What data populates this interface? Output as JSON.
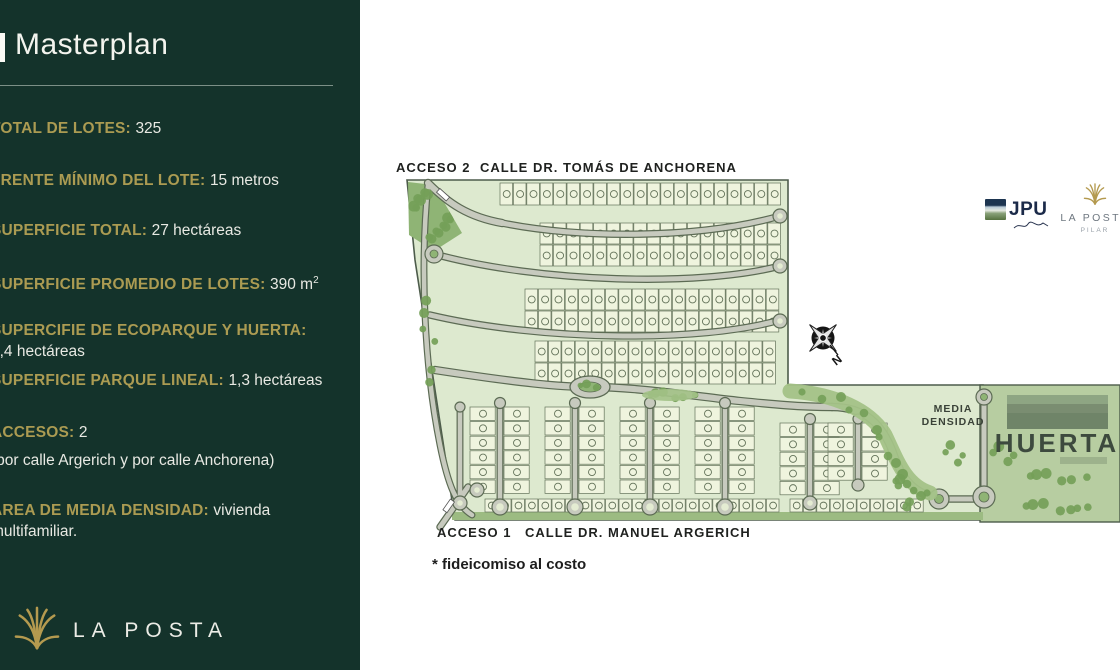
{
  "sidebar": {
    "title": "Masterplan",
    "items": [
      {
        "label": "TOTAL DE LOTES: ",
        "value": "325"
      },
      {
        "label": "FRENTE MÍNIMO DEL LOTE: ",
        "value": "15 metros"
      },
      {
        "label": "SUPERFICIE TOTAL: ",
        "value": "27 hectáreas"
      },
      {
        "label": "SUPERFICIE PROMEDIO DE LOTES: ",
        "value": "390 m",
        "superscript": "2"
      },
      {
        "label": "SUPERCIFIE DE ECOPARQUE Y HUERTA:",
        "value": "4,4 hectáreas"
      },
      {
        "label": "SUPERFICIE PARQUE LINEAL: ",
        "value": "1,3 hectáreas"
      },
      {
        "label": "ACCESOS: ",
        "value": "2",
        "note": "(por calle Argerich y por calle Anchorena)"
      },
      {
        "label": "ÁREA DE MEDIA DENSIDAD: ",
        "value": "vivienda multifamiliar."
      }
    ],
    "footer_logo_text": "LA POSTA"
  },
  "map": {
    "acceso2": "ACCESO 2",
    "calle_top": "CALLE DR. TOMÁS DE ANCHORENA",
    "acceso1": "ACCESO 1",
    "calle_bottom": "CALLE DR. MANUEL ARGERICH",
    "media_densidad_line1": "MEDIA",
    "media_densidad_line2": "DENSIDAD",
    "huerta": "HUERTA",
    "compass_n": "N"
  },
  "footnote": "* fideicomiso al costo",
  "logos": {
    "jpu": {
      "name": "JPU"
    },
    "la_posta_top": {
      "name": "LA POSTA",
      "location": "PILAR"
    }
  },
  "colors": {
    "sidebar_bg": "#14332b",
    "accent_gold": "#ab9b52",
    "text_light": "#e8e9e3",
    "map_bg": "#dde9cf",
    "lot_fill": "#eff4de",
    "road_fill": "#c7cabe",
    "road_casing": "#5c6b54",
    "tree_green": "#74a058",
    "park_green": "#a3c287",
    "huerta_bg": "#b7cda1",
    "map_label_dark": "#1f211f"
  }
}
